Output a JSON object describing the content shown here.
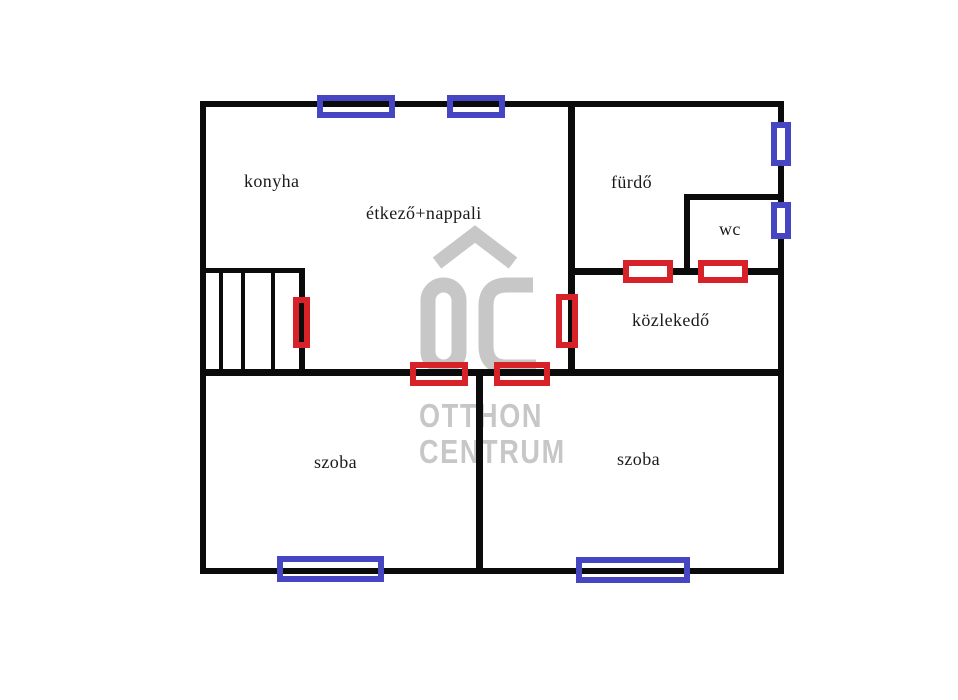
{
  "colors": {
    "wall": "#0b0b0b",
    "door": "#d8222a",
    "window": "#4646c3",
    "watermark": "#c7c7c7",
    "label": "#1a1a1a",
    "background": "#ffffff"
  },
  "rooms": {
    "konyha": {
      "label": "konyha"
    },
    "etkezo_nappali": {
      "label": "étkező+nappali"
    },
    "furdo": {
      "label": "fürdő"
    },
    "wc": {
      "label": "wc"
    },
    "kozlekedo": {
      "label": "közlekedő"
    },
    "szoba_left": {
      "label": "szoba"
    },
    "szoba_right": {
      "label": "szoba"
    }
  },
  "watermark": {
    "logo": "OC",
    "line1": "OTTHON",
    "line2": "CENTRUM"
  }
}
